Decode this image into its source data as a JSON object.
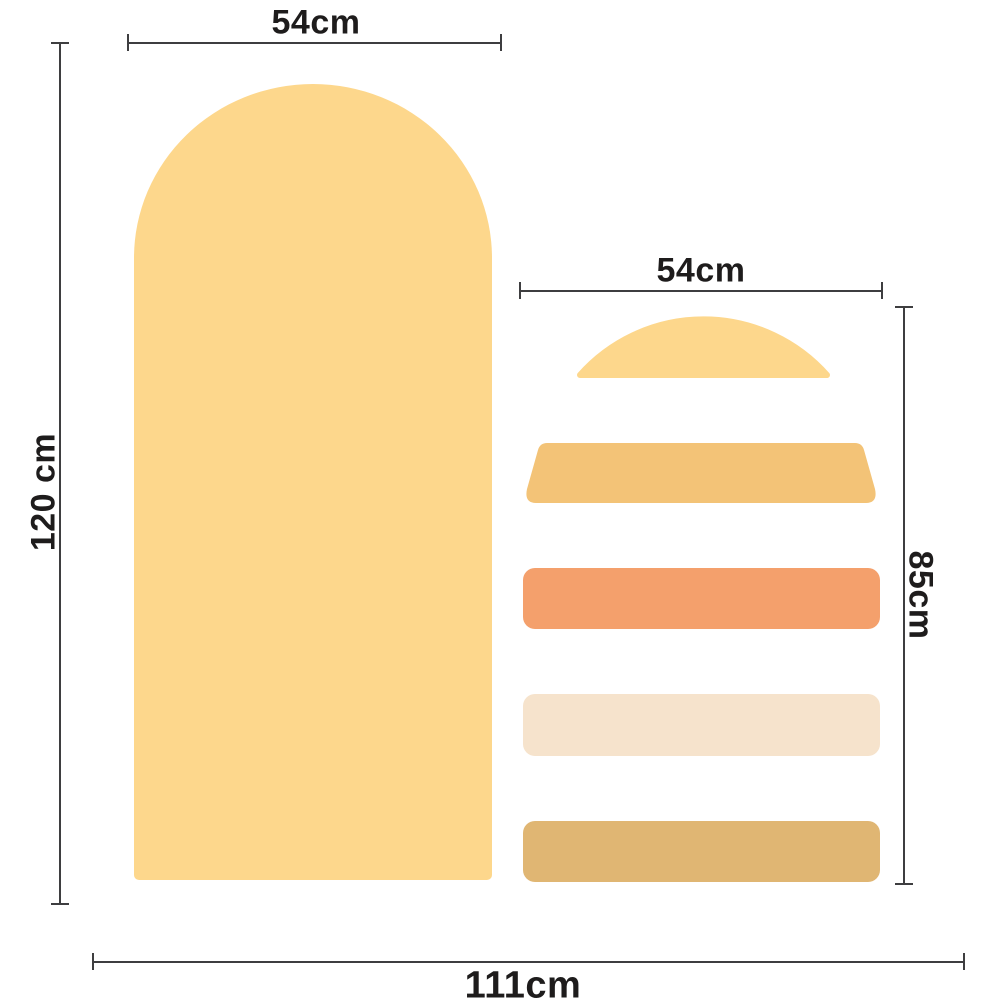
{
  "measurements": {
    "arch_width": {
      "label": "54cm"
    },
    "arch_height": {
      "label": "120 cm"
    },
    "pieces_width": {
      "label": "54cm"
    },
    "pieces_height": {
      "label": "85cm"
    },
    "total_width": {
      "label": "111cm"
    }
  },
  "colors": {
    "light_yellow": "#FDD78C",
    "golden_yellow": "#F3C377",
    "orange": "#F4A06C",
    "cream": "#F6E3CC",
    "tan": "#E0B673",
    "measure_line": "#3E3E40",
    "label_text": "#1E1C1C",
    "background": "#FFFFFF"
  }
}
